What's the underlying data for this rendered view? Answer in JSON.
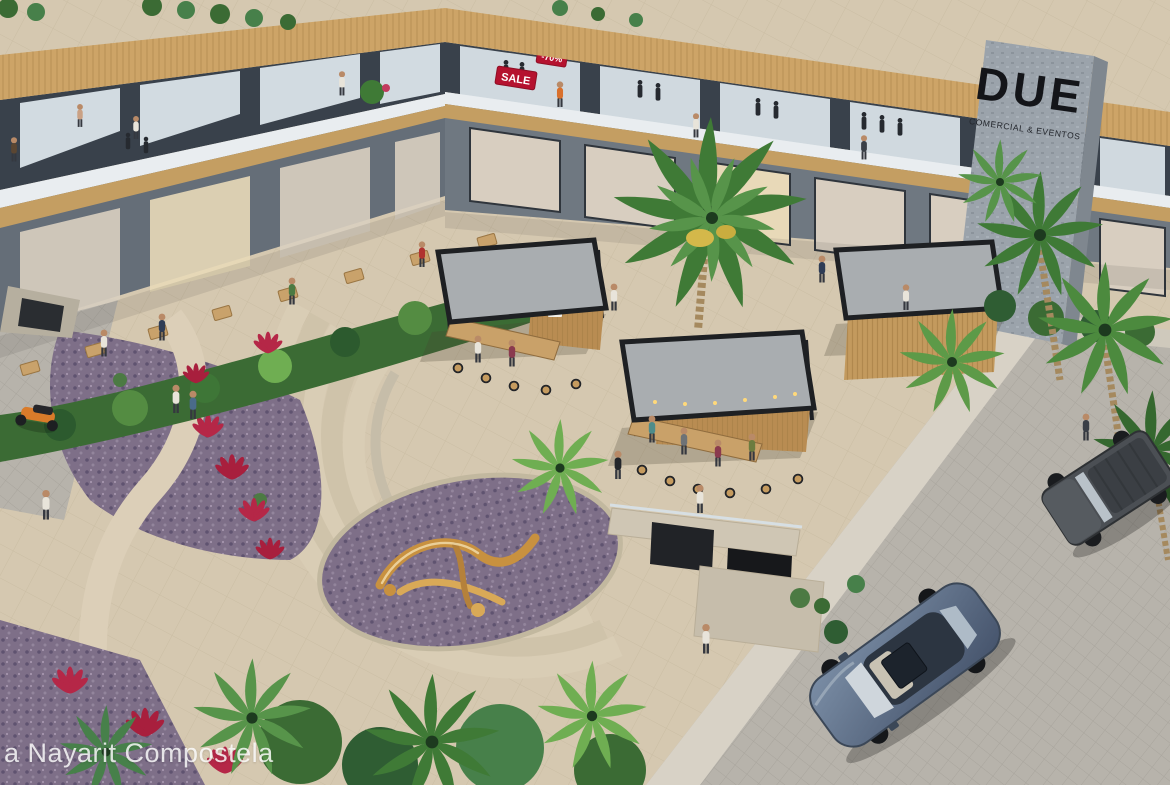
{
  "meta": {
    "type": "architectural-rendering-aerial",
    "subject": "DUE open-air shopping and dining plaza, Riviera Nayarit Compostela",
    "watermark": "a Nayarit Compostela"
  },
  "signs": {
    "tower_title": "DUE",
    "tower_subtitle": "COMERCIAL & EVENTOS",
    "sale": "SALE",
    "discount": "-70%"
  },
  "scene": {
    "building": "L-shaped two-storey retail building: upper floor fashion boutiques with glass fronts and mannequins, timber-slat roof fascia, glass-railed walkway; ground floor arcade cafés with outdoor dining terrace on the left wing; grey stone sign tower on the right",
    "plaza": "central beige-paved plaza with three flat-roof food kiosks with timber bars and stools, string lights, one large central palm, curved amphitheater steps, winding path, purple flower beds with red cordylines, golden abstract sculpture, sunken stair entrance",
    "street": "cobbled street along the right edge with a steel-blue hatchback and a grey SUV parked; small side street on the left with an orange scooter",
    "people": "shoppers, diners and pedestrians throughout"
  },
  "objects": {
    "kiosks": 3,
    "cars": 2,
    "scooters": 1,
    "sculptures": 1,
    "amphitheater_step_arcs": 5,
    "terrace_tables": 8,
    "people_visible": "about 30"
  },
  "colors": {
    "paving": "#d5c8b0",
    "street_cobble": "#b7b3ab",
    "wood_fascia": "#cda467",
    "building_dark": "#39414b",
    "building_gray": "#6f7881",
    "glass": "#dfe8ee",
    "walkway": "#e9edf0",
    "stone_tower": "#9ba3ab",
    "sign_red": "#b5122f",
    "due_letters": "#141519",
    "kiosk_roof": "#a9adb0",
    "kiosk_frame": "#202226",
    "kiosk_wood": "#c39a5e",
    "foliage": "#3e7637",
    "purple_bed": "#7e6f88",
    "red_plant": "#b52747",
    "sculpture_gold": "#c8913f",
    "car_blue": "#5d7089",
    "suv_gray": "#4b4f54",
    "scooter_orange": "#d97b2a"
  }
}
